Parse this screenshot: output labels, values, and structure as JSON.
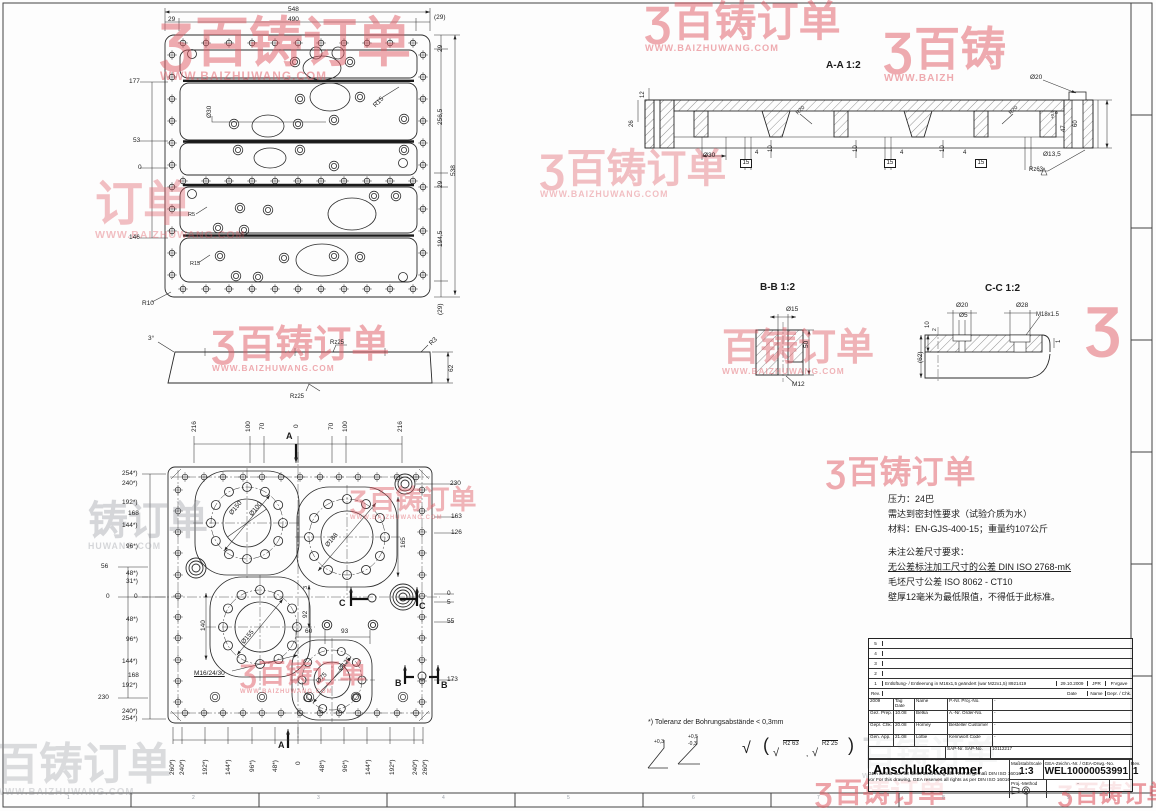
{
  "watermark_brand": "百铸订单",
  "watermark_logo": "Ʒ",
  "watermark_url": "WWW.BAIZHUWANG.COM",
  "accent_red": "#e05a64",
  "watermarks": [
    {
      "logo": 1,
      "t": "百铸订单",
      "u": "WWW.BAIZHUWANG.COM",
      "x": 160,
      "y": 18,
      "s": 54,
      "c": "red",
      "o": 0.5
    },
    {
      "logo": 1,
      "t": "百铸订单",
      "u": "WWW.BAIZHUWANG.COM",
      "x": 645,
      "y": 2,
      "s": 42,
      "c": "red",
      "o": 0.5
    },
    {
      "logo": 1,
      "t": "百铸",
      "u": "WWW.BAIZH",
      "x": 884,
      "y": 28,
      "s": 46,
      "c": "red",
      "o": 0.5
    },
    {
      "t": "订单",
      "u": "WWW.BAIZHUWANG.COM",
      "x": 95,
      "y": 182,
      "s": 48,
      "c": "red",
      "o": 0.38
    },
    {
      "logo": 1,
      "t": "百铸订单",
      "u": "WWW.BAIZHUWANG.COM",
      "x": 540,
      "y": 150,
      "s": 40,
      "c": "red",
      "o": 0.38
    },
    {
      "logo": 1,
      "t": "百铸订单",
      "u": "WWW.BAIZHUWANG.COM",
      "x": 212,
      "y": 327,
      "s": 38,
      "c": "red",
      "o": 0.5
    },
    {
      "t": "百铸订单",
      "u": "WWW.BAIZHUWANG.COM",
      "x": 722,
      "y": 330,
      "s": 38,
      "c": "red",
      "o": 0.45
    },
    {
      "logo": 1,
      "t": "",
      "u": "",
      "x": 1086,
      "y": 300,
      "s": 56,
      "c": "red",
      "o": 0.5
    },
    {
      "logo": 1,
      "t": "百铸订单",
      "u": "",
      "x": 826,
      "y": 457,
      "s": 32,
      "c": "red",
      "o": 0.5
    },
    {
      "logo": 1,
      "t": "百铸订单",
      "u": "WWW.BAIZHUWANG.COM",
      "x": 350,
      "y": 488,
      "s": 27,
      "c": "red",
      "o": 0.45
    },
    {
      "t": "铸订单",
      "u": "HUWANG.COM",
      "x": 88,
      "y": 502,
      "s": 40,
      "c": "gray",
      "o": 0.35
    },
    {
      "logo": 1,
      "t": "百铸订单",
      "u": "WWW.BAIZHUWANG.COM",
      "x": 240,
      "y": 662,
      "s": 27,
      "c": "red",
      "o": 0.5
    },
    {
      "t": "百铸订单",
      "u": "WWW.BAIZHUWANG.COM",
      "x": -5,
      "y": 744,
      "s": 44,
      "c": "gray",
      "o": 0.3
    },
    {
      "t": "百铸订单",
      "u": "WWW.BAIZHUWANG.COM",
      "x": 862,
      "y": 738,
      "s": 34,
      "c": "gray",
      "o": 0.32
    },
    {
      "logo": 1,
      "t": "百铸订单",
      "u": "",
      "x": 815,
      "y": 780,
      "s": 28,
      "c": "red",
      "o": 0.55
    },
    {
      "logo": 1,
      "t": "百铸订单",
      "u": "",
      "x": 1058,
      "y": 784,
      "s": 24,
      "c": "red",
      "o": 0.6
    }
  ],
  "labels": {
    "top_view": [
      {
        "t": "548",
        "x": 288,
        "y": 6
      },
      {
        "t": "29",
        "x": 168,
        "y": 16
      },
      {
        "t": "490",
        "x": 288,
        "y": 16
      },
      {
        "t": "(29)",
        "x": 434,
        "y": 14
      },
      {
        "t": "29",
        "x": 437,
        "y": 52,
        "r": -90
      },
      {
        "t": "256,5",
        "x": 437,
        "y": 125,
        "r": -90
      },
      {
        "t": "538",
        "x": 450,
        "y": 176,
        "r": -90
      },
      {
        "t": "29",
        "x": 437,
        "y": 188,
        "r": -90
      },
      {
        "t": "194,5",
        "x": 437,
        "y": 247,
        "r": -90
      },
      {
        "t": "(29)",
        "x": 437,
        "y": 315,
        "r": -90
      },
      {
        "t": "177",
        "x": 129,
        "y": 78
      },
      {
        "t": "53",
        "x": 133,
        "y": 137
      },
      {
        "t": "0",
        "x": 138,
        "y": 164
      },
      {
        "t": "146",
        "x": 129,
        "y": 234
      },
      {
        "t": "Ø30",
        "x": 206,
        "y": 118,
        "r": -90
      },
      {
        "t": "R15",
        "x": 372,
        "y": 104,
        "r": -45
      },
      {
        "t": "R5",
        "x": 188,
        "y": 212,
        "s": 5.5
      },
      {
        "t": "R15",
        "x": 190,
        "y": 261,
        "s": 5.5
      },
      {
        "t": "R10",
        "x": 142,
        "y": 300
      }
    ],
    "side_view": [
      {
        "t": "3°",
        "x": 148,
        "y": 335
      },
      {
        "t": "Rz25",
        "x": 330,
        "y": 340,
        "s": 6
      },
      {
        "t": "R3",
        "x": 428,
        "y": 342,
        "r": -45
      },
      {
        "t": "62",
        "x": 448,
        "y": 372,
        "r": -90
      },
      {
        "t": "Rz25",
        "x": 290,
        "y": 394,
        "s": 6
      }
    ],
    "bottom_view": [
      {
        "t": "216",
        "x": 191,
        "y": 432,
        "r": -90
      },
      {
        "t": "100",
        "x": 245,
        "y": 432,
        "r": -90
      },
      {
        "t": "70",
        "x": 259,
        "y": 430,
        "r": -90
      },
      {
        "t": "0",
        "x": 293,
        "y": 428,
        "r": -90
      },
      {
        "t": "70",
        "x": 328,
        "y": 430,
        "r": -90
      },
      {
        "t": "100",
        "x": 342,
        "y": 432,
        "r": -90
      },
      {
        "t": "216",
        "x": 397,
        "y": 432,
        "r": -90
      },
      {
        "t": "A",
        "x": 286,
        "y": 432,
        "b": 1,
        "s": 9
      },
      {
        "t": "A",
        "x": 278,
        "y": 741,
        "b": 1,
        "s": 9
      },
      {
        "t": "254*)",
        "x": 122,
        "y": 470
      },
      {
        "t": "240*)",
        "x": 122,
        "y": 480
      },
      {
        "t": "192*)",
        "x": 122,
        "y": 499
      },
      {
        "t": "168",
        "x": 128,
        "y": 510
      },
      {
        "t": "144*)",
        "x": 122,
        "y": 522
      },
      {
        "t": "96*)",
        "x": 126,
        "y": 543
      },
      {
        "t": "56",
        "x": 101,
        "y": 563
      },
      {
        "t": "48*)",
        "x": 126,
        "y": 570
      },
      {
        "t": "31*)",
        "x": 126,
        "y": 578
      },
      {
        "t": "0",
        "x": 134,
        "y": 593
      },
      {
        "t": "0",
        "x": 106,
        "y": 593
      },
      {
        "t": "48*)",
        "x": 126,
        "y": 616
      },
      {
        "t": "96*)",
        "x": 126,
        "y": 636
      },
      {
        "t": "144*)",
        "x": 122,
        "y": 658
      },
      {
        "t": "168",
        "x": 128,
        "y": 672
      },
      {
        "t": "192*)",
        "x": 122,
        "y": 682
      },
      {
        "t": "230",
        "x": 98,
        "y": 694
      },
      {
        "t": "240*)",
        "x": 122,
        "y": 708
      },
      {
        "t": "254*)",
        "x": 122,
        "y": 715
      },
      {
        "t": "230",
        "x": 450,
        "y": 480
      },
      {
        "t": "163",
        "x": 451,
        "y": 513
      },
      {
        "t": "126",
        "x": 451,
        "y": 529
      },
      {
        "t": "165",
        "x": 400,
        "y": 548,
        "r": -90
      },
      {
        "t": "0",
        "x": 447,
        "y": 590
      },
      {
        "t": "5",
        "x": 447,
        "y": 599
      },
      {
        "t": "55",
        "x": 447,
        "y": 618
      },
      {
        "t": "173",
        "x": 447,
        "y": 676
      },
      {
        "t": "260*)",
        "x": 169,
        "y": 775,
        "r": -90
      },
      {
        "t": "240*)",
        "x": 179,
        "y": 775,
        "r": -90
      },
      {
        "t": "192*)",
        "x": 202,
        "y": 775,
        "r": -90
      },
      {
        "t": "144*)",
        "x": 225,
        "y": 775,
        "r": -90
      },
      {
        "t": "96*)",
        "x": 249,
        "y": 772,
        "r": -90
      },
      {
        "t": "48*)",
        "x": 272,
        "y": 772,
        "r": -90
      },
      {
        "t": "0",
        "x": 295,
        "y": 765,
        "r": -90
      },
      {
        "t": "48*)",
        "x": 319,
        "y": 772,
        "r": -90
      },
      {
        "t": "96*)",
        "x": 342,
        "y": 772,
        "r": -90
      },
      {
        "t": "144*)",
        "x": 365,
        "y": 775,
        "r": -90
      },
      {
        "t": "192*)",
        "x": 389,
        "y": 775,
        "r": -90
      },
      {
        "t": "240*)",
        "x": 412,
        "y": 775,
        "r": -90
      },
      {
        "t": "260*)",
        "x": 422,
        "y": 775,
        "r": -90
      },
      {
        "t": "Ø150",
        "x": 228,
        "y": 512,
        "r": -50
      },
      {
        "t": "Ø100",
        "x": 248,
        "y": 513,
        "r": -50
      },
      {
        "t": "Ø188",
        "x": 324,
        "y": 544,
        "r": -50
      },
      {
        "t": "Ø155",
        "x": 240,
        "y": 641,
        "r": -50
      },
      {
        "t": "Ø125",
        "x": 337,
        "y": 668,
        "r": -50
      },
      {
        "t": "Ø75",
        "x": 315,
        "y": 680,
        "r": -45
      },
      {
        "t": "140",
        "x": 200,
        "y": 631,
        "r": -90
      },
      {
        "t": "92",
        "x": 302,
        "y": 618,
        "r": -90
      },
      {
        "t": "3",
        "x": 303,
        "y": 589,
        "r": -90,
        "s": 5.5
      },
      {
        "t": "60",
        "x": 305,
        "y": 628
      },
      {
        "t": "93",
        "x": 341,
        "y": 628
      },
      {
        "t": "M16/24/30",
        "x": 194,
        "y": 670,
        "u": 1
      },
      {
        "t": "C",
        "x": 339,
        "y": 599,
        "b": 1,
        "s": 9
      },
      {
        "t": "C",
        "x": 419,
        "y": 602,
        "b": 1,
        "s": 9
      },
      {
        "t": "B",
        "x": 395,
        "y": 679,
        "b": 1,
        "s": 9
      },
      {
        "t": "B",
        "x": 441,
        "y": 681,
        "b": 1,
        "s": 9
      }
    ],
    "aa_section": [
      {
        "t": "A-A 1:2",
        "x": 826,
        "y": 60,
        "b": 1,
        "s": 10
      },
      {
        "t": "12",
        "x": 640,
        "y": 98,
        "r": -90,
        "s": 6
      },
      {
        "t": "26",
        "x": 629,
        "y": 127,
        "r": -90,
        "s": 6
      },
      {
        "t": "Ø30",
        "x": 703,
        "y": 152
      },
      {
        "t": "4",
        "x": 755,
        "y": 150,
        "s": 6
      },
      {
        "t": "15",
        "x": 740,
        "y": 159,
        "box": 1,
        "s": 6
      },
      {
        "t": "10",
        "x": 768,
        "y": 152,
        "r": -90,
        "s": 6
      },
      {
        "t": "R20",
        "x": 795,
        "y": 112,
        "r": -45,
        "s": 5.5
      },
      {
        "t": "10",
        "x": 853,
        "y": 152,
        "r": -90,
        "s": 6
      },
      {
        "t": "15",
        "x": 884,
        "y": 159,
        "box": 1,
        "s": 6
      },
      {
        "t": "4",
        "x": 900,
        "y": 150,
        "s": 6
      },
      {
        "t": "10",
        "x": 940,
        "y": 152,
        "r": -90,
        "s": 6
      },
      {
        "t": "4",
        "x": 963,
        "y": 150,
        "s": 6
      },
      {
        "t": "15",
        "x": 975,
        "y": 159,
        "box": 1,
        "s": 6
      },
      {
        "t": "R20",
        "x": 1008,
        "y": 112,
        "r": -45,
        "s": 5.5
      },
      {
        "t": "Ø20",
        "x": 1030,
        "y": 74
      },
      {
        "t": "+0,5",
        "x": 1051,
        "y": 119,
        "r": -90,
        "s": 4.5
      },
      {
        "t": "0",
        "x": 1055,
        "y": 114,
        "r": -90,
        "s": 4.5
      },
      {
        "t": "47",
        "x": 1061,
        "y": 132,
        "r": -90,
        "s": 6
      },
      {
        "t": "60",
        "x": 1073,
        "y": 127,
        "r": -90,
        "s": 6
      },
      {
        "t": "Ø13,5",
        "x": 1043,
        "y": 151
      },
      {
        "t": "Rz63",
        "x": 1029,
        "y": 167,
        "s": 6
      }
    ],
    "bb_section": [
      {
        "t": "B-B 1:2",
        "x": 760,
        "y": 282,
        "b": 1,
        "s": 10
      },
      {
        "t": "Ø15",
        "x": 786,
        "y": 306
      },
      {
        "t": "50",
        "x": 803,
        "y": 348,
        "r": -90
      },
      {
        "t": "M12",
        "x": 792,
        "y": 381
      }
    ],
    "cc_section": [
      {
        "t": "C-C 1:2",
        "x": 985,
        "y": 283,
        "b": 1,
        "s": 10
      },
      {
        "t": "Ø20",
        "x": 956,
        "y": 302
      },
      {
        "t": "Ø5",
        "x": 959,
        "y": 312
      },
      {
        "t": "Ø28",
        "x": 1016,
        "y": 302
      },
      {
        "t": "M18x1.5",
        "x": 1036,
        "y": 312,
        "s": 6
      },
      {
        "t": "10",
        "x": 925,
        "y": 328,
        "r": -90,
        "s": 6
      },
      {
        "t": "2",
        "x": 933,
        "y": 331,
        "r": -90,
        "s": 5
      },
      {
        "t": "(62)",
        "x": 917,
        "y": 363,
        "r": -90
      },
      {
        "t": "1",
        "x": 1056,
        "y": 343,
        "r": -90,
        "s": 6
      }
    ],
    "notes": [
      {
        "t": "压力：24巴",
        "x": 888,
        "y": 495,
        "s": 9
      },
      {
        "t": "需达到密封性要求（试验介质为水）",
        "x": 888,
        "y": 510,
        "s": 9
      },
      {
        "t": "材料：EN-GJS-400-15；重量约107公斤",
        "x": 888,
        "y": 525,
        "s": 9
      },
      {
        "t": "未注公差尺寸要求：",
        "x": 888,
        "y": 548,
        "s": 9
      },
      {
        "t": "无公差标注加工尺寸的公差 DIN ISO 2768-mK",
        "x": 888,
        "y": 563,
        "s": 9,
        "u": 1
      },
      {
        "t": "毛坯尺寸公差 ISO 8062 - CT10",
        "x": 888,
        "y": 578,
        "s": 9
      },
      {
        "t": "壁厚12毫米为最低限值，不得低于此标准。",
        "x": 888,
        "y": 593,
        "s": 9
      }
    ],
    "footnotes": [
      {
        "t": "*) Toleranz der Bohrungsabstände < 0,3mm",
        "x": 648,
        "y": 719,
        "s": 7
      },
      {
        "t": "+0,3",
        "x": 654,
        "y": 740,
        "s": 5
      },
      {
        "t": "+0,5",
        "x": 688,
        "y": 735,
        "s": 5
      },
      {
        "t": "-0,3",
        "x": 688,
        "y": 742,
        "s": 5
      },
      {
        "t": "√",
        "x": 742,
        "y": 740,
        "s": 16
      },
      {
        "t": "(",
        "x": 763,
        "y": 736,
        "s": 18
      },
      {
        "t": "√",
        "x": 773,
        "y": 747,
        "s": 11
      },
      {
        "t": "Rz 63",
        "x": 783,
        "y": 740,
        "s": 6,
        "ol": 1
      },
      {
        "t": ",",
        "x": 806,
        "y": 750,
        "s": 8
      },
      {
        "t": "√",
        "x": 812,
        "y": 747,
        "s": 11
      },
      {
        "t": "Rz 25",
        "x": 822,
        "y": 740,
        "s": 6,
        "ol": 1
      },
      {
        "t": ")",
        "x": 848,
        "y": 736,
        "s": 18
      }
    ],
    "frame": [
      {
        "t": "1",
        "x": 67,
        "y": 796,
        "s": 5,
        "g": 1
      },
      {
        "t": "2",
        "x": 192,
        "y": 796,
        "s": 5,
        "g": 1
      },
      {
        "t": "3",
        "x": 317,
        "y": 796,
        "s": 5,
        "g": 1
      },
      {
        "t": "4",
        "x": 442,
        "y": 796,
        "s": 5,
        "g": 1
      },
      {
        "t": "5",
        "x": 567,
        "y": 796,
        "s": 5,
        "g": 1
      },
      {
        "t": "6",
        "x": 692,
        "y": 796,
        "s": 5,
        "g": 1
      },
      {
        "t": "7",
        "x": 817,
        "y": 796,
        "s": 5,
        "g": 1
      },
      {
        "t": "8",
        "x": 942,
        "y": 796,
        "s": 5,
        "g": 1
      },
      {
        "t": "9",
        "x": 1067,
        "y": 796,
        "s": 5,
        "g": 1
      }
    ]
  },
  "title_block": {
    "rev_rows": [
      {
        "no": "5",
        "desc": "",
        "date": "",
        "name": "",
        "chk": ""
      },
      {
        "no": "4",
        "desc": "",
        "date": "",
        "name": "",
        "chk": ""
      },
      {
        "no": "3",
        "desc": "",
        "date": "",
        "name": "",
        "chk": ""
      },
      {
        "no": "2",
        "desc": "",
        "date": "",
        "name": "",
        "chk": ""
      },
      {
        "no": "1",
        "desc": "Entlüftung- / Entleerung in M16x1,5 geändert (war M22x1,5) 8921419",
        "date": "29.10.2009",
        "name": "JPR",
        "chk": "P.Vgave"
      }
    ],
    "rev_header": {
      "no": "Rev.",
      "desc": "",
      "date": "Date",
      "name": "Name",
      "chk": "Gepr. / Chk."
    },
    "grid": {
      "year": "2009",
      "tag": "Tag\nDate",
      "name_hdr": "Name",
      "pnr": "P.-Nr.\nProj.-No.",
      "pnr_val": "-",
      "gez": "Gez.\nPrep.",
      "gez_date": "10.08",
      "gez_name": "Betka",
      "anr": "A.-Nr.\nOrder-No.",
      "anr_val": "-",
      "gepr": "Gepr.\nChk.",
      "gepr_date": "20.08",
      "gepr_name": "Horney",
      "best": "Besteller\nCustomer",
      "best_val": "-",
      "gen": "Gen.\nApp.",
      "gen_date": "21.08",
      "gen_name": "Lottie",
      "kenn": "Kennwort\nCode",
      "kenn_val": "-",
      "sap": "SAP-Nr.\nSAP-No.",
      "sap_val": "10112217"
    },
    "title": "Anschlußkammer",
    "scale_label": "Maßstab/Scale",
    "scale": "1:3",
    "drawing_label": "GEA-Zeichn.-Nr. / GEA-Drwg.-No.",
    "drawing_no": "WEL10000053991",
    "rev_label": "Rev.",
    "rev": "1",
    "method_label": "Proj.-Method",
    "method_val": "-",
    "copyright_de": "GEA behält sich für diese Zeichnung alle Rechte gemäß DIN ISO 16016",
    "copyright_en": "vor For this drawing, GEA reserves all rights as per DIN ISO 16016"
  }
}
